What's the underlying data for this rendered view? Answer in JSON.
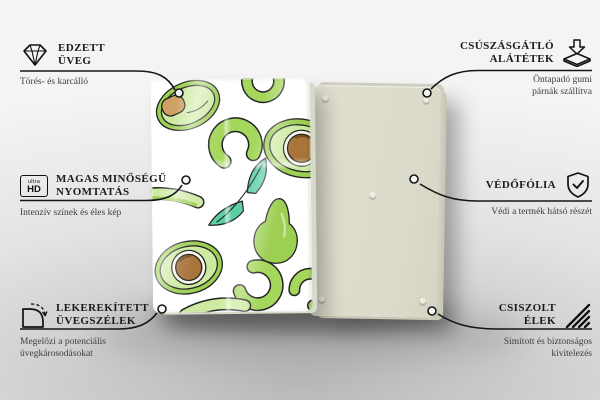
{
  "callouts": {
    "left": [
      {
        "icon": "diamond-icon",
        "title": [
          "EDZETT",
          "ÜVEG"
        ],
        "subtitle": "Törés- és karcálló"
      },
      {
        "icon": "ultra-hd-icon",
        "icon_text": {
          "top": "ultra",
          "bottom": "HD"
        },
        "title": [
          "MAGAS MINŐSÉGŰ",
          "NYOMTATÁS"
        ],
        "subtitle": "Intenzív színek és éles kép"
      },
      {
        "icon": "rounded-corner-icon",
        "title": [
          "LEKEREKÍTETT",
          "ÜVEGSZÉLEK"
        ],
        "subtitle": "Megelőzi a potenciális üvegkárosodásokat"
      }
    ],
    "right": [
      {
        "icon": "anti-slip-pad-icon",
        "title": [
          "CSÚSZÁSGÁTLÓ",
          "ALÁTÉTEK"
        ],
        "subtitle": "Öntapadó gumi párnák szállítva"
      },
      {
        "icon": "shield-check-icon",
        "title": [
          "VÉDŐFÓLIA"
        ],
        "subtitle": "Védi a termék hátsó részét"
      },
      {
        "icon": "polished-edge-icon",
        "title": [
          "CSISZOLT",
          "ÉLEK"
        ],
        "subtitle": "Simított és biztonságos kivitelezés"
      }
    ]
  },
  "colors": {
    "green-skin": "#9ccf52",
    "green-flesh": "#cdeaa0",
    "green-slice": "#a5d75c",
    "pit-brown": "#a9743a",
    "pit-tan": "#cfa063",
    "leaf-teal": "#5bcfa3",
    "back-beige": "#e0dfd0",
    "back-edge": "#c9c8b5",
    "line": "#161616"
  }
}
